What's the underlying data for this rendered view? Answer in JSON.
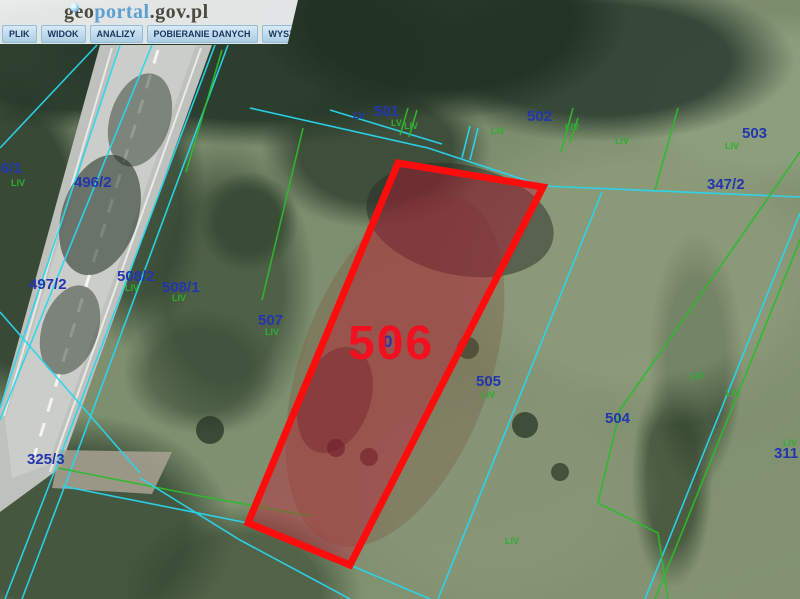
{
  "header": {
    "logo": {
      "part1": "geo",
      "part2": "portal",
      "part3": ".gov.pl"
    },
    "menu": [
      "PLIK",
      "WIDOK",
      "ANALIZY",
      "POBIERANIE DANYCH",
      "WYSZUKIWANIA"
    ]
  },
  "map": {
    "colors": {
      "boundary_cyan": "#29d6ee",
      "boundary_green": "#2db92d",
      "parcel_number_blue": "#2336ad",
      "section_green": "#2fae2f",
      "highlight_red": "#ff0b0b",
      "highlight_fill": "rgba(193,28,54,0.42)",
      "highlight_text": "#f2101f"
    },
    "highlighted_parcel": {
      "number": "506",
      "label": {
        "t": "506",
        "x": 348,
        "y": 320,
        "size": 48
      },
      "polygon": [
        [
          398,
          163
        ],
        [
          543,
          187
        ],
        [
          350,
          565
        ],
        [
          248,
          523
        ]
      ]
    },
    "parcel_labels": [
      {
        "t": "501",
        "x": 374,
        "y": 104
      },
      {
        "t": "LV",
        "x": 353,
        "y": 112,
        "s": 10
      },
      {
        "t": "502",
        "x": 527,
        "y": 109
      },
      {
        "t": "503",
        "x": 742,
        "y": 126
      },
      {
        "t": "347/2",
        "x": 707,
        "y": 177
      },
      {
        "t": "6/1",
        "x": 1,
        "y": 161
      },
      {
        "t": "496/2",
        "x": 74,
        "y": 175
      },
      {
        "t": "497/2",
        "x": 29,
        "y": 277
      },
      {
        "t": "508/2",
        "x": 117,
        "y": 269
      },
      {
        "t": "508/1",
        "x": 162,
        "y": 280
      },
      {
        "t": "507",
        "x": 258,
        "y": 313
      },
      {
        "t": "0",
        "x": 383,
        "y": 333,
        "s": 17
      },
      {
        "t": "505",
        "x": 476,
        "y": 374
      },
      {
        "t": "504",
        "x": 605,
        "y": 411
      },
      {
        "t": "311",
        "x": 774,
        "y": 446
      },
      {
        "t": "325/3",
        "x": 27,
        "y": 452
      }
    ],
    "section_labels": [
      {
        "t": "LV",
        "x": 391,
        "y": 119
      },
      {
        "t": "LIV",
        "x": 404,
        "y": 122
      },
      {
        "t": "LIV",
        "x": 491,
        "y": 127
      },
      {
        "t": "LIV",
        "x": 565,
        "y": 123
      },
      {
        "t": "LIV",
        "x": 615,
        "y": 137
      },
      {
        "t": "LIV",
        "x": 725,
        "y": 142
      },
      {
        "t": "LIV",
        "x": 11,
        "y": 179
      },
      {
        "t": "LIV",
        "x": 125,
        "y": 284
      },
      {
        "t": "LIV",
        "x": 172,
        "y": 294
      },
      {
        "t": "LIV",
        "x": 265,
        "y": 328
      },
      {
        "t": "LIV",
        "x": 481,
        "y": 391
      },
      {
        "t": "LIII",
        "x": 690,
        "y": 372
      },
      {
        "t": "LIV",
        "x": 726,
        "y": 389
      },
      {
        "t": "LIV",
        "x": 783,
        "y": 439
      },
      {
        "t": "LIV",
        "x": 505,
        "y": 537
      }
    ],
    "boundary_lines": [
      {
        "c": "cyan",
        "pts": [
          [
            120,
            45
          ],
          [
            0,
            408
          ]
        ]
      },
      {
        "c": "cyan",
        "pts": [
          [
            152,
            45
          ],
          [
            45,
            308
          ],
          [
            0,
            420
          ]
        ]
      },
      {
        "c": "cyan",
        "pts": [
          [
            97,
            45
          ],
          [
            0,
            148
          ]
        ]
      },
      {
        "c": "cyan",
        "pts": [
          [
            215,
            45
          ],
          [
            55,
            470
          ],
          [
            5,
            599
          ]
        ]
      },
      {
        "c": "cyan",
        "pts": [
          [
            228,
            45
          ],
          [
            70,
            472
          ],
          [
            22,
            599
          ]
        ]
      },
      {
        "c": "green",
        "pts": [
          [
            222,
            50
          ],
          [
            186,
            172
          ]
        ]
      },
      {
        "c": "cyan",
        "pts": [
          [
            250,
            108
          ],
          [
            428,
            148
          ],
          [
            543,
            186
          ],
          [
            800,
            197
          ]
        ]
      },
      {
        "c": "cyan",
        "pts": [
          [
            330,
            110
          ],
          [
            442,
            144
          ]
        ]
      },
      {
        "c": "green",
        "pts": [
          [
            303,
            128
          ],
          [
            262,
            300
          ]
        ]
      },
      {
        "c": "cyan",
        "pts": [
          [
            602,
            192
          ],
          [
            438,
            599
          ]
        ]
      },
      {
        "c": "cyan",
        "pts": [
          [
            800,
            213
          ],
          [
            645,
            599
          ]
        ]
      },
      {
        "c": "green",
        "pts": [
          [
            800,
            240
          ],
          [
            655,
            599
          ]
        ]
      },
      {
        "c": "green",
        "pts": [
          [
            800,
            152
          ],
          [
            697,
            300
          ],
          [
            620,
            410
          ],
          [
            598,
            503
          ],
          [
            658,
            533
          ],
          [
            668,
            599
          ]
        ]
      },
      {
        "c": "green",
        "pts": [
          [
            678,
            108
          ],
          [
            655,
            190
          ]
        ]
      },
      {
        "c": "green",
        "pts": [
          [
            573,
            108
          ],
          [
            561,
            152
          ]
        ]
      },
      {
        "c": "green",
        "pts": [
          [
            408,
            108
          ],
          [
            400,
            135
          ]
        ]
      },
      {
        "c": "green",
        "pts": [
          [
            417,
            110
          ],
          [
            409,
            137
          ]
        ]
      },
      {
        "c": "cyan",
        "pts": [
          [
            470,
            126
          ],
          [
            462,
            158
          ]
        ]
      },
      {
        "c": "cyan",
        "pts": [
          [
            478,
            128
          ],
          [
            470,
            160
          ]
        ]
      },
      {
        "c": "green",
        "pts": [
          [
            578,
            118
          ],
          [
            570,
            143
          ]
        ]
      },
      {
        "c": "green",
        "pts": [
          [
            58,
            468
          ],
          [
            200,
            496
          ],
          [
            310,
            516
          ]
        ]
      },
      {
        "c": "cyan",
        "pts": [
          [
            62,
            486
          ],
          [
            248,
            523
          ],
          [
            350,
            565
          ],
          [
            430,
            599
          ]
        ]
      },
      {
        "c": "cyan",
        "pts": [
          [
            140,
            478
          ],
          [
            240,
            540
          ],
          [
            350,
            599
          ]
        ]
      },
      {
        "c": "cyan",
        "pts": [
          [
            0,
            312
          ],
          [
            140,
            473
          ]
        ]
      }
    ]
  }
}
